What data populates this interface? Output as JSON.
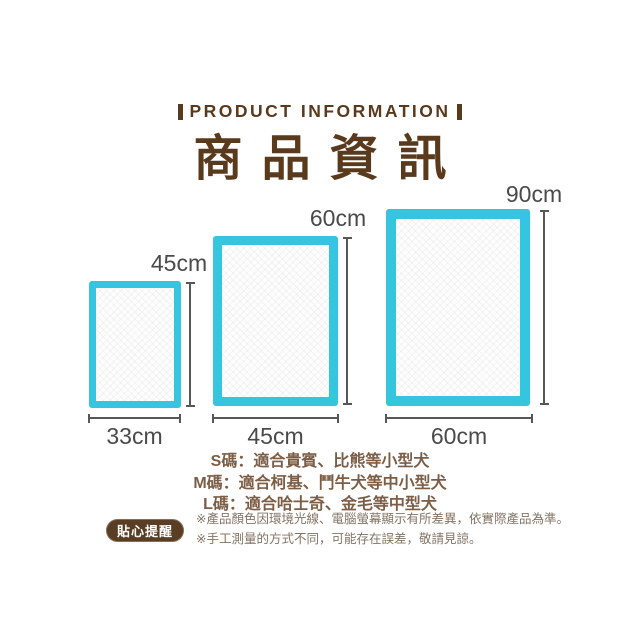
{
  "colors": {
    "brand_brown": "#5a3a1c",
    "pad_border_cyan": "#36c5de",
    "dimension_gray": "#4a4a4a",
    "size_text_brown": "#7c5e47",
    "badge_background": "#5a3e24",
    "note_text": "#837364"
  },
  "header": {
    "eyebrow": "PRODUCT INFORMATION",
    "title": "商品資訊"
  },
  "diagram": {
    "pads": [
      {
        "size": "S",
        "width_label": "33cm",
        "height_label": "45cm"
      },
      {
        "size": "M",
        "width_label": "45cm",
        "height_label": "60cm"
      },
      {
        "size": "L",
        "width_label": "60cm",
        "height_label": "90cm"
      }
    ]
  },
  "size_guide": {
    "lines": [
      "S碼：適合貴賓、比熊等小型犬",
      "M碼：適合柯基、鬥牛犬等中小型犬",
      "L碼：適合哈士奇、金毛等中型犬"
    ]
  },
  "reminder": {
    "badge_label": "貼心提醒",
    "notes": [
      "※產品顏色因環境光線、電腦螢幕顯示有所差異，依實際產品為準。",
      "※手工測量的方式不同，可能存在誤差，敬請見諒。"
    ]
  }
}
